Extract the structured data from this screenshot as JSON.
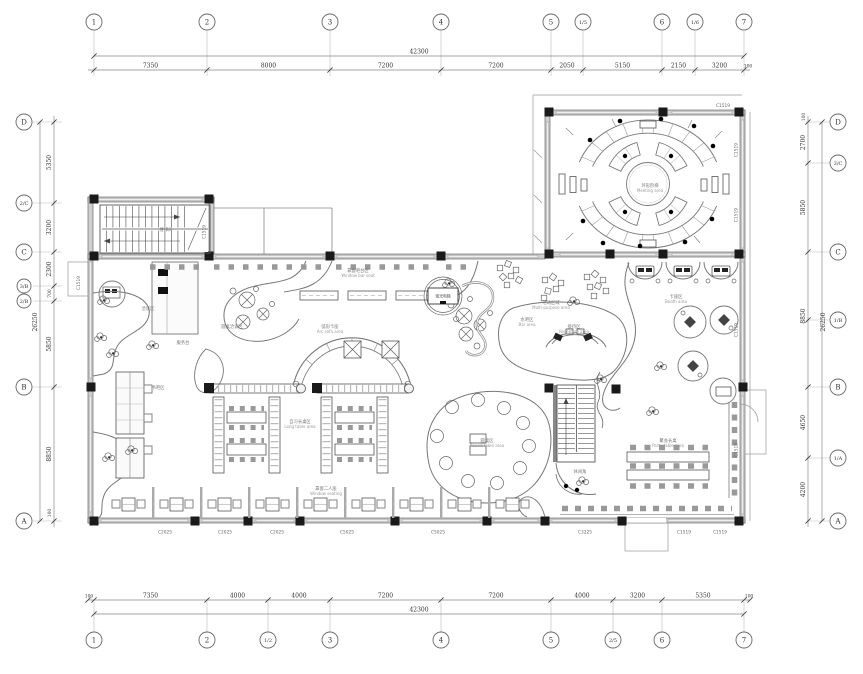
{
  "plan": {
    "grid_top": {
      "bubbles": [
        "1",
        "2",
        "3",
        "4",
        "5",
        "1/5",
        "6",
        "1/6",
        "7"
      ],
      "dims": [
        "7350",
        "8000",
        "7200",
        "7200",
        "2050",
        "5150",
        "2150",
        "3200"
      ],
      "edge": "100",
      "total": "42300"
    },
    "grid_bottom": {
      "bubbles": [
        "1",
        "2",
        "1/2",
        "3",
        "4",
        "5",
        "2/5",
        "6",
        "7"
      ],
      "dims": [
        "7350",
        "4000",
        "4000",
        "7200",
        "7200",
        "4000",
        "3200",
        "5350"
      ],
      "edge_left": "100",
      "edge_right": "100",
      "total": "42300"
    },
    "grid_left": {
      "bubbles": [
        "D",
        "2/C",
        "C",
        "3/B",
        "2/B",
        "B",
        "A"
      ],
      "dims": [
        "5350",
        "3200",
        "2300",
        "700",
        "5850",
        "8850"
      ],
      "edge": "100",
      "total": "26250"
    },
    "grid_right": {
      "bubbles": [
        "D",
        "3/C",
        "C",
        "1/B",
        "B",
        "1/A",
        "A"
      ],
      "dims": [
        "2700",
        "5850",
        "8850",
        "4650",
        "4200"
      ],
      "edge": "100",
      "total": "26250"
    },
    "windows": {
      "bottom": [
        "C2025",
        "C2025",
        "C2025",
        "C5025",
        "C5025",
        "C3225",
        "C1519",
        "C1519"
      ],
      "right": [
        "C1519",
        "C1519",
        "C1519",
        "C1519"
      ],
      "left_nook": "C1519",
      "stair": "C1519",
      "top_right": "C1519"
    },
    "rooms": {
      "hall_zh": "环形阶梯",
      "hall_en": "Meeting area",
      "window_bar_zh": "靠窗吧台区",
      "window_bar_en": "Window bar seat",
      "arc_zh": "弧形卡座",
      "arc_en": "Arc sofa area",
      "elevator": "观光电梯",
      "bar_zh": "水吧区",
      "bar_en": "Bar area",
      "multi_zh": "活动区域",
      "multi_en": "Multi-purpose area",
      "crescent_zh": "接待区",
      "crescent_en": "Reception area",
      "booth_zh": "卡座区",
      "booth_en": "Booth area",
      "study_zh": "自习长桌区",
      "study_en": "Long table area",
      "book_zh": "书吧区",
      "round_zh": "圆桌区",
      "round_en": "Round table area",
      "party_zh": "聚会长桌",
      "party_en": "Party table area",
      "winseat_zh": "靠窗二人座",
      "winseat_en": "Window seating",
      "corner_zh": "休闲角",
      "lounge_zh": "洽谈区",
      "desk_zh": "服务台",
      "rtables_zh": "圆桌洽谈区",
      "stair_zh": "楼梯间"
    }
  }
}
